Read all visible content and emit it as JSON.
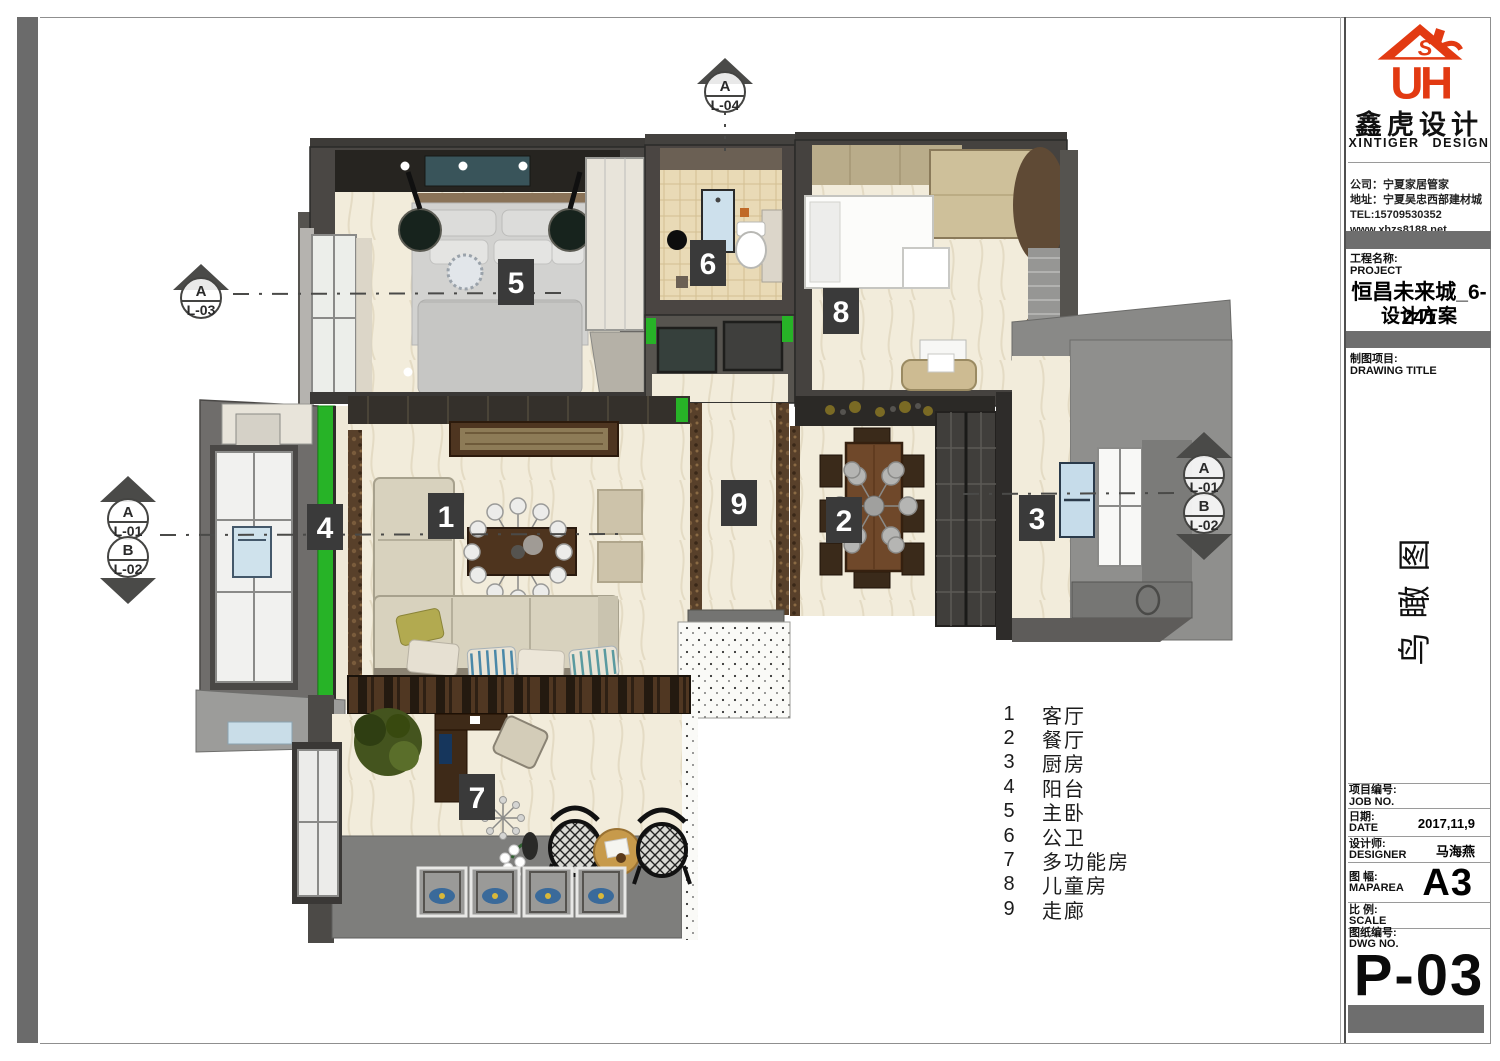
{
  "titleblock": {
    "logo": {
      "letter_s": "S",
      "letters": "UH",
      "brand_cn": "鑫虎设计",
      "brand_en": "XINTIGER DESIGN",
      "brand_color": "#e23a12"
    },
    "company": {
      "lines": [
        "公司：宁夏家居管家",
        "地址：宁夏吴忠西部建材城",
        "TEL:15709530352",
        "www.xhzs8188.net"
      ]
    },
    "project": {
      "label_cn": "工程名称:",
      "label_en": "PROJECT",
      "name_line1": "恒昌未来城_6-241",
      "name_line2": "设计方案"
    },
    "drawing": {
      "label_cn": "制图项目:",
      "label_en": "DRAWING TITLE",
      "view_title": "鸟瞰图"
    },
    "fields": {
      "job_cn": "项目编号:",
      "job_en": "JOB NO.",
      "job_value": "",
      "date_cn": "日期:",
      "date_en": "DATE",
      "date_value": "2017,11,9",
      "designer_cn": "设计师:",
      "designer_en": "DESIGNER",
      "designer_value": "马海燕",
      "maparea_cn": "图  幅:",
      "maparea_en": "MAPAREA",
      "maparea_value": "A3",
      "scale_cn": "比  例:",
      "scale_en": "SCALE",
      "scale_value": "",
      "dwg_cn": "图纸编号:",
      "dwg_en": "DWG NO.",
      "dwg_value": "P-03"
    }
  },
  "plan": {
    "tags": [
      "1",
      "2",
      "3",
      "4",
      "5",
      "6",
      "7",
      "8",
      "9"
    ],
    "markers": {
      "top": {
        "letter": "A",
        "code": "L-04"
      },
      "left": {
        "letter": "A",
        "code": "L-03"
      },
      "west_a": {
        "letter": "A",
        "code": "L-01"
      },
      "west_b": {
        "letter": "B",
        "code": "L-02"
      },
      "east_a": {
        "letter": "A",
        "code": "L-01"
      },
      "east_b": {
        "letter": "B",
        "code": "L-02"
      }
    }
  },
  "legend": {
    "items": [
      {
        "num": "1",
        "label": "客厅"
      },
      {
        "num": "2",
        "label": "餐厅"
      },
      {
        "num": "3",
        "label": "厨房"
      },
      {
        "num": "4",
        "label": "阳台"
      },
      {
        "num": "5",
        "label": "主卧"
      },
      {
        "num": "6",
        "label": "公卫"
      },
      {
        "num": "7",
        "label": "多功能房"
      },
      {
        "num": "8",
        "label": "儿童房"
      },
      {
        "num": "9",
        "label": "走廊"
      }
    ]
  },
  "colors": {
    "accent_green": "#27b327",
    "wall_dark": "#45423e",
    "floor_cream": "#f2ecdb",
    "bar_gray": "#6e6e6e",
    "logo_red": "#e23a12"
  }
}
